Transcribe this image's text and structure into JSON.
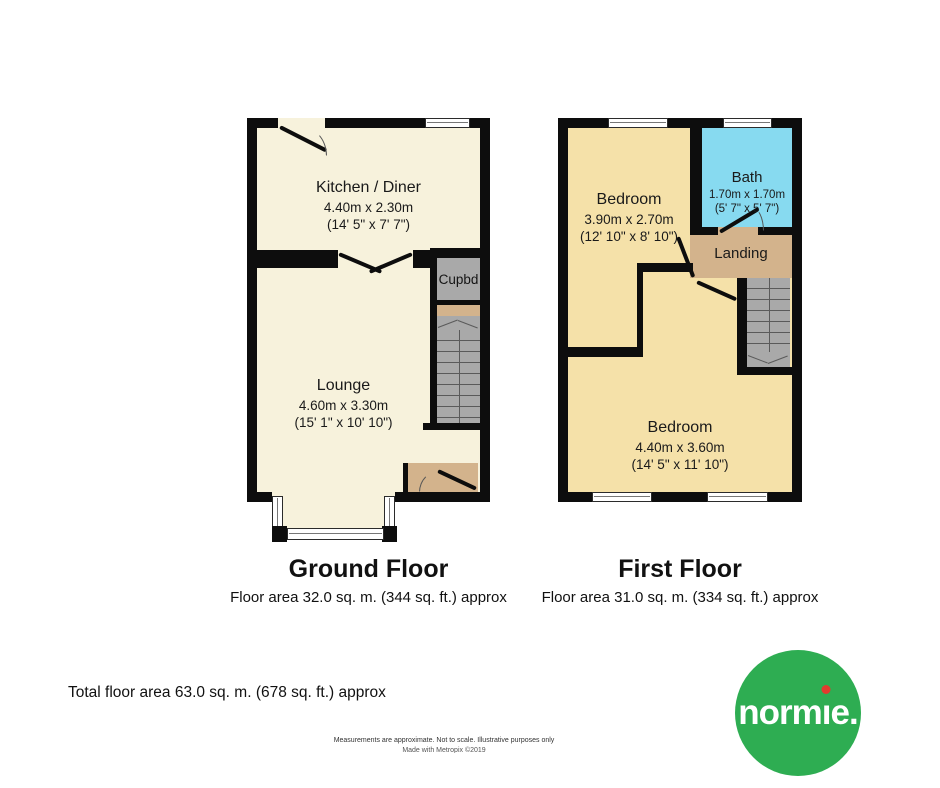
{
  "colors": {
    "wall": "#0d0d0d",
    "ground-room": "#f7f2dc",
    "first-room": "#f5e1a9",
    "bath": "#87daf0",
    "landing": "#d3b38c",
    "stairs": "#a9a9a9",
    "stair-line": "#5a5a5a",
    "text": "#1a1a1a",
    "logo-green": "#2ead52",
    "logo-red": "#e23b2e"
  },
  "floors": [
    {
      "title": "Ground Floor",
      "area": "Floor area 32.0 sq. m. (344 sq. ft.) approx",
      "rooms": [
        {
          "name": "Kitchen / Diner",
          "metric": "4.40m x 2.30m",
          "imperial": "(14' 5\" x 7' 7\")"
        },
        {
          "name": "Lounge",
          "metric": "4.60m x 3.30m",
          "imperial": "(15' 1\" x 10' 10\")"
        },
        {
          "name": "Cupbd"
        }
      ]
    },
    {
      "title": "First Floor",
      "area": "Floor area 31.0 sq. m. (334 sq. ft.) approx",
      "rooms": [
        {
          "name": "Bedroom",
          "metric": "3.90m x 2.70m",
          "imperial": "(12' 10\" x 8' 10\")"
        },
        {
          "name": "Bath",
          "metric": "1.70m x 1.70m",
          "imperial": "(5' 7\" x 5' 7\")"
        },
        {
          "name": "Landing"
        },
        {
          "name": "Bedroom",
          "metric": "4.40m x 3.60m",
          "imperial": "(14' 5\" x 11' 10\")"
        }
      ]
    }
  ],
  "footer": {
    "total_area": "Total floor area 63.0 sq. m. (678 sq. ft.) approx",
    "disclaimer": "Measurements are approximate.  Not to scale.  Illustrative purposes only",
    "credit": "Made with Metropix ©2019"
  },
  "logo": {
    "name": "normie.",
    "part_pre": "norm",
    "part_i": "ı",
    "part_post": "e."
  }
}
